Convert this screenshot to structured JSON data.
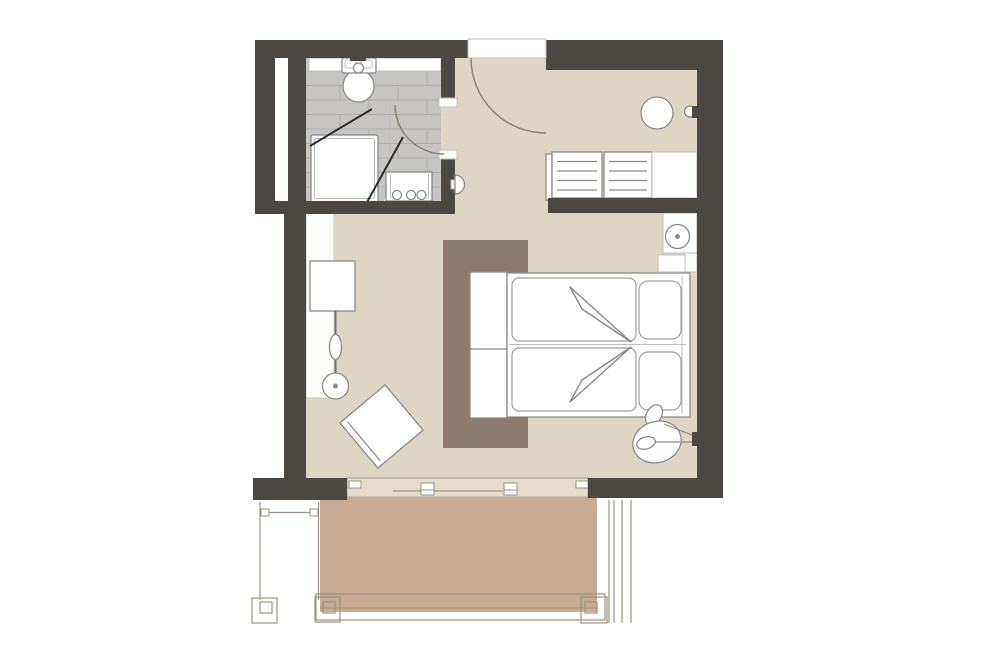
{
  "document": {
    "type": "floor-plan",
    "description": "hotel room floor plan with bathroom, bedroom, entry and terrace"
  },
  "colors": {
    "background": "#ffffff",
    "wall": "#4b4743",
    "floor": "#ded6c4",
    "tile": "#c6c5c3",
    "tile_line": "#b1b0ae",
    "terrace": "#c8ab92",
    "panel": "#8b7b6e",
    "door_band": "#e5ddcb",
    "outline": "#8a8a8a",
    "outline_light": "#bdbdbd",
    "balcony_line": "#9a9383",
    "arc": "#8d8273",
    "glass": "#2b2b2b"
  },
  "rooms": [
    "bathroom",
    "bedroom",
    "entry-vestibule",
    "balcony-terrace"
  ],
  "fixtures": [
    "toilet",
    "shower",
    "vanity-basin",
    "bathroom-door",
    "entrance-door",
    "wall-sconce",
    "wardrobe-band",
    "desk-console",
    "coat-stand",
    "floor-lamp",
    "armchair",
    "headboard-panel-rug",
    "foot-bench",
    "double-bed",
    "pillows",
    "duvet-folds",
    "nightstand",
    "table-lamp",
    "reading-arc-lamp",
    "round-table",
    "wall-hook",
    "luggage-bench",
    "sideboard",
    "sliding-glass-door",
    "terrace-deck",
    "railing",
    "corner-posts"
  ]
}
